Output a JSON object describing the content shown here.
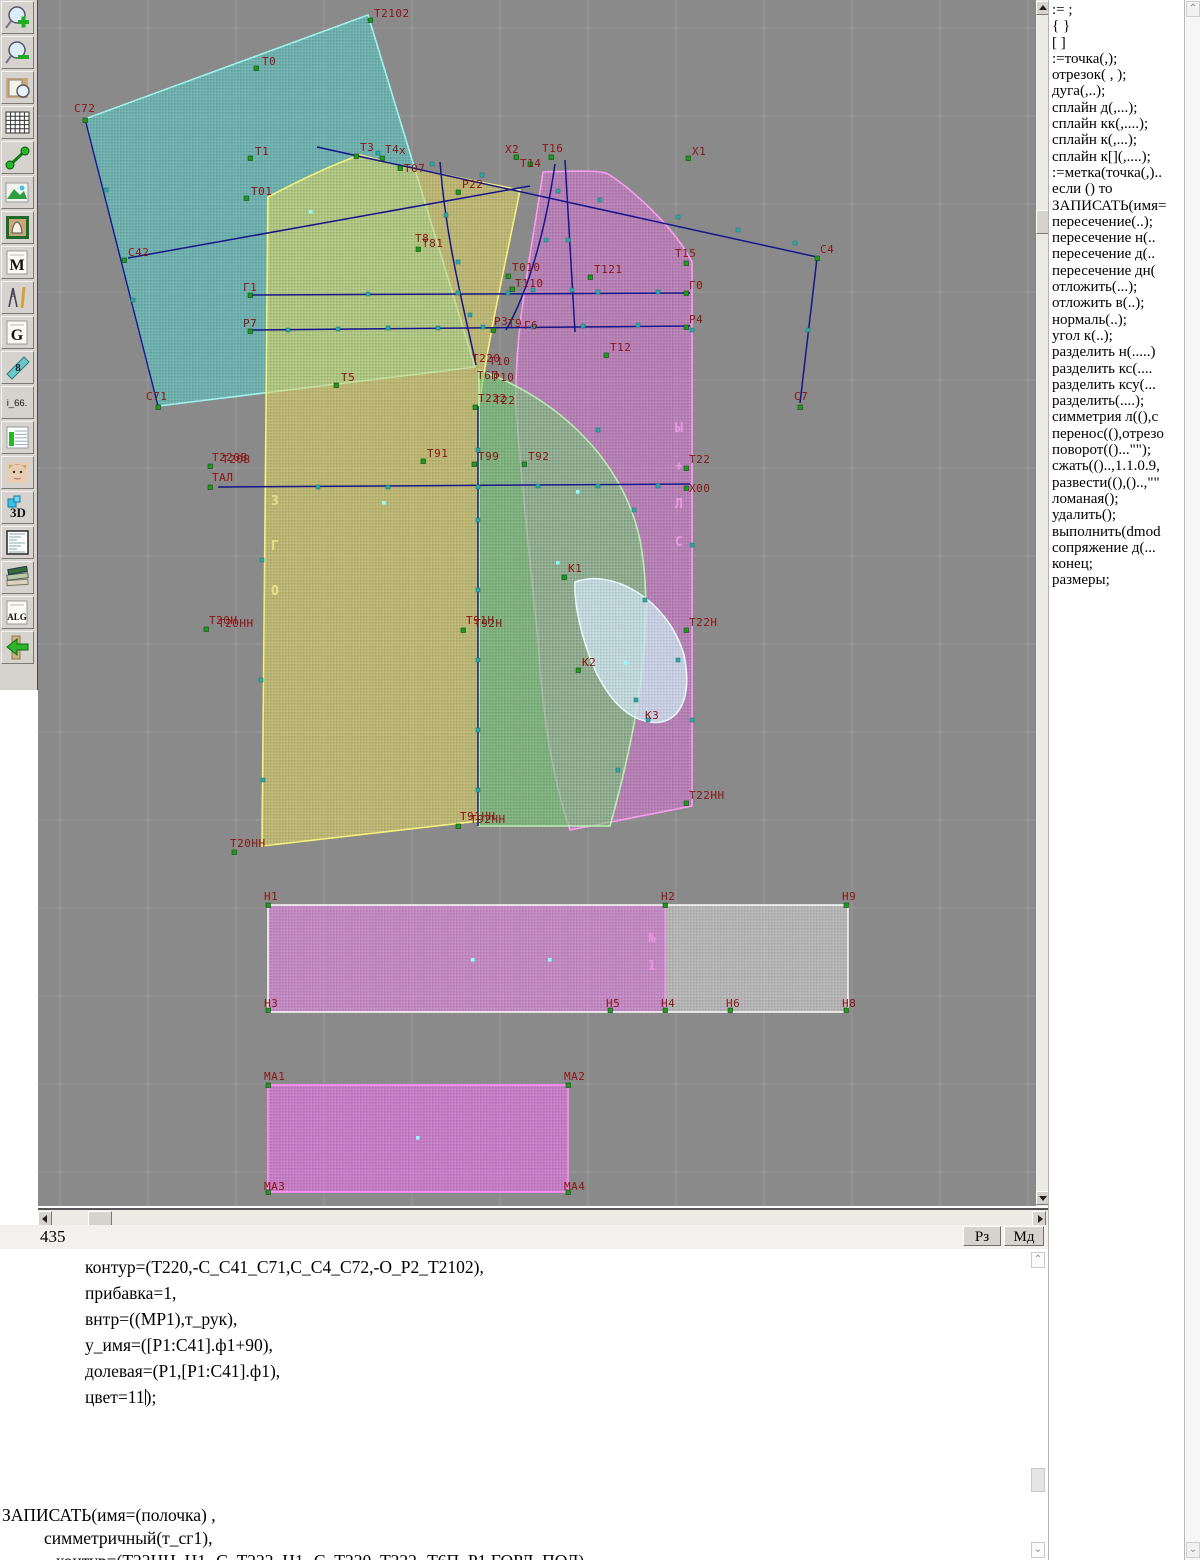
{
  "app": {
    "status_left": "435",
    "mode_buttons": [
      {
        "label": "Рз"
      },
      {
        "label": "Мд"
      }
    ]
  },
  "toolbar": {
    "items": [
      {
        "name": "zoom-in-icon",
        "type": "lensplus",
        "label": ""
      },
      {
        "name": "zoom-out-icon",
        "type": "lensminus",
        "label": ""
      },
      {
        "name": "preview-icon",
        "type": "doclens",
        "label": ""
      },
      {
        "name": "grid-icon",
        "type": "grid",
        "label": ""
      },
      {
        "name": "segment-icon",
        "type": "dumbbell",
        "label": ""
      },
      {
        "name": "image-icon",
        "type": "photo",
        "label": ""
      },
      {
        "name": "pattern-frame-icon",
        "type": "frame",
        "label": ""
      },
      {
        "name": "m-doc-icon",
        "type": "letterdoc",
        "label": "M"
      },
      {
        "name": "drafting-icon",
        "type": "compass",
        "label": ""
      },
      {
        "name": "g-doc-icon",
        "type": "letterdoc",
        "label": "G"
      },
      {
        "name": "ruler-icon",
        "type": "ruler",
        "label": "8"
      },
      {
        "name": "i66-icon",
        "type": "textbtn",
        "label": "i_66."
      },
      {
        "name": "table-chart-icon",
        "type": "chart",
        "label": ""
      },
      {
        "name": "model-photo-icon",
        "type": "face",
        "label": ""
      },
      {
        "name": "3d-icon",
        "type": "threed",
        "label": "3D"
      },
      {
        "name": "list-icon",
        "type": "listdoc",
        "label": ""
      },
      {
        "name": "books-icon",
        "type": "books",
        "label": ""
      },
      {
        "name": "alg-icon",
        "type": "letterdoc",
        "label": "ALG"
      },
      {
        "name": "exit-icon",
        "type": "arrow",
        "label": ""
      }
    ]
  },
  "command_list": [
    ":= ;",
    "{  }",
    "[  ]",
    ":=точка(,);",
    "отрезок( , );",
    "дуга(,..);",
    "сплайн  д(,...);",
    "сплайн  кк(,....);",
    "сплайн  к(,...);",
    "сплайн  к[](,....);",
    ":=метка(точка(,)..",
    "если () то",
    "ЗАПИСАТЬ(имя=",
    "пересечение(..);",
    "пересечение  н(..",
    "пересечение  д(..",
    "пересечение  дн(",
    "отложить(...);",
    "отложить  в(..);",
    "нормаль(..);",
    "угол  к(..);",
    "разделить  н(.....)",
    "разделить  кс(....",
    "разделить  ксу(...",
    "разделить(....);",
    "симметрия  л((),c",
    "перенос((),отрезо",
    "поворот(()...\"\");",
    "сжать(()..,1.1.0.9,",
    "развести((),()..,\"\"",
    "ломаная();",
    "удалить();",
    "выполнить(dmod",
    "сопряжение  д(...",
    "конец;",
    "размеры;"
  ],
  "editor": {
    "block1": [
      "контур=(Т220,-С_С41_С71,С_С4_С72,-О_Р2_Т2102),",
      "прибавка=1,",
      "внтр=((МР1),т_рук),",
      "у_имя=([Р1:С41].ф1+90),",
      "долевая=(Р1,[Р1:С41].ф1),"
    ],
    "cursor_line": {
      "pre": "цвет=11",
      "post": ");"
    },
    "block2": [
      "ЗАПИСАТЬ(имя=(полочка) ,",
      "симметричный(т_сг1),",
      "контур=(Т22НН_Н1,-С_Т222_Н1,-С_Т220_Т222,-Т6П_Р1,ГОРЛ_ПОЛ),"
    ],
    "block2_indents": [
      0,
      42,
      54
    ]
  },
  "canvas": {
    "label_color": "#8b1414",
    "marker_color": "#1f9a1f",
    "teal_color": "#2fa8a8",
    "dot_color": "#8ffcff",
    "line_color": "#16168c",
    "points": [
      [
        "Т2102",
        332,
        20,
        336,
        17
      ],
      [
        "Т0",
        218,
        68,
        224,
        65
      ],
      [
        "С72",
        47,
        120,
        36,
        112
      ],
      [
        "Т1",
        212,
        158,
        217,
        155
      ],
      [
        "Т01",
        208,
        198,
        213,
        195
      ],
      [
        "Т3",
        318,
        156,
        322,
        151
      ],
      [
        "Т4",
        344,
        158,
        347,
        153
      ],
      [
        "х",
        365,
        152,
        361,
        154,
        1
      ],
      [
        "Т07",
        362,
        168,
        366,
        172
      ],
      [
        "Р22",
        420,
        192,
        424,
        188
      ],
      [
        "Х2",
        478,
        157,
        467,
        153
      ],
      [
        "Т14",
        492,
        164,
        482,
        167
      ],
      [
        "Т16",
        513,
        157,
        504,
        152
      ],
      [
        "Х1",
        650,
        158,
        654,
        155
      ],
      [
        "С42",
        86,
        260,
        90,
        256
      ],
      [
        "Т5",
        298,
        385,
        303,
        381
      ],
      [
        "Т8",
        374,
        246,
        377,
        242,
        1
      ],
      [
        "Т81",
        380,
        249,
        384,
        247
      ],
      [
        "Г1",
        212,
        295,
        205,
        291
      ],
      [
        "Г0",
        648,
        293,
        651,
        289
      ],
      [
        "Р7",
        212,
        331,
        205,
        327
      ],
      [
        "Р4",
        648,
        327,
        651,
        323
      ],
      [
        "Т121",
        552,
        277,
        556,
        273
      ],
      [
        "Т15",
        648,
        263,
        637,
        257
      ],
      [
        "Т010",
        470,
        276,
        474,
        271
      ],
      [
        "Т110",
        474,
        289,
        477,
        287
      ],
      [
        "Р3",
        455,
        330,
        456,
        325
      ],
      [
        "Т9",
        468,
        331,
        470,
        327,
        1
      ],
      [
        "Г6",
        482,
        332,
        486,
        329,
        1
      ],
      [
        "Т12",
        568,
        355,
        572,
        351
      ],
      [
        "С4",
        779,
        258,
        782,
        253
      ],
      [
        "С71",
        120,
        407,
        108,
        400
      ],
      [
        "С7",
        762,
        407,
        756,
        400
      ],
      [
        "Т220",
        432,
        367,
        434,
        362,
        1
      ],
      [
        "Т10",
        447,
        369,
        451,
        365,
        1
      ],
      [
        "Т6П",
        437,
        377,
        439,
        379,
        1
      ],
      [
        "Р10",
        452,
        379,
        455,
        381,
        1
      ],
      [
        "Т222",
        437,
        407,
        440,
        402
      ],
      [
        "Т22",
        452,
        408,
        456,
        404,
        1
      ],
      [
        "Т91",
        385,
        461,
        389,
        457
      ],
      [
        "Т99",
        436,
        464,
        440,
        460
      ],
      [
        "Т92",
        486,
        464,
        490,
        460
      ],
      [
        "Т220В",
        172,
        466,
        174,
        461
      ],
      [
        "Т20В",
        180,
        467,
        184,
        463,
        1
      ],
      [
        "ТАЛ",
        172,
        487,
        174,
        481
      ],
      [
        "Т22",
        648,
        468,
        651,
        463
      ],
      [
        "Х00",
        648,
        488,
        651,
        492
      ],
      [
        "К1",
        526,
        577,
        530,
        572
      ],
      [
        "К2",
        540,
        670,
        544,
        666
      ],
      [
        "К3",
        603,
        723,
        607,
        719,
        1
      ],
      [
        "Т20Н",
        168,
        629,
        171,
        624
      ],
      [
        "Т20НН",
        176,
        631,
        180,
        627,
        1
      ],
      [
        "Т91Н",
        425,
        630,
        428,
        624
      ],
      [
        "Т92Н",
        432,
        631,
        436,
        627,
        1
      ],
      [
        "Т22Н",
        648,
        630,
        651,
        626
      ],
      [
        "Т22НН",
        648,
        803,
        651,
        799
      ],
      [
        "Т91НН",
        420,
        826,
        422,
        820
      ],
      [
        "Т92НН",
        428,
        827,
        432,
        823,
        1
      ],
      [
        "Т20НН",
        196,
        852,
        192,
        847
      ],
      [
        "Н1",
        230,
        905,
        226,
        900
      ],
      [
        "Н2",
        627,
        905,
        623,
        900
      ],
      [
        "Н9",
        808,
        905,
        804,
        900
      ],
      [
        "Н3",
        230,
        1010,
        226,
        1007
      ],
      [
        "Н5",
        572,
        1010,
        568,
        1007
      ],
      [
        "Н4",
        627,
        1010,
        623,
        1007
      ],
      [
        "Н6",
        692,
        1010,
        688,
        1007
      ],
      [
        "Н8",
        808,
        1010,
        804,
        1007
      ],
      [
        "МА1",
        230,
        1085,
        226,
        1080
      ],
      [
        "МА2",
        530,
        1085,
        526,
        1080
      ],
      [
        "МА3",
        230,
        1192,
        226,
        1190
      ],
      [
        "МА4",
        530,
        1192,
        526,
        1190
      ]
    ],
    "teal_markers": [
      [
        340,
        153
      ],
      [
        394,
        164
      ],
      [
        444,
        175
      ],
      [
        520,
        191
      ],
      [
        562,
        200
      ],
      [
        640,
        217
      ],
      [
        700,
        230
      ],
      [
        757,
        243
      ],
      [
        770,
        330
      ],
      [
        330,
        294
      ],
      [
        420,
        293
      ],
      [
        470,
        293
      ],
      [
        560,
        292
      ],
      [
        620,
        292
      ],
      [
        250,
        330
      ],
      [
        300,
        329
      ],
      [
        350,
        328
      ],
      [
        400,
        328
      ],
      [
        445,
        327
      ],
      [
        495,
        327
      ],
      [
        545,
        326
      ],
      [
        600,
        325
      ],
      [
        280,
        487
      ],
      [
        350,
        487
      ],
      [
        440,
        487
      ],
      [
        500,
        486
      ],
      [
        560,
        486
      ],
      [
        620,
        486
      ],
      [
        408,
        215
      ],
      [
        420,
        262
      ],
      [
        432,
        315
      ],
      [
        508,
        240
      ],
      [
        495,
        290
      ],
      [
        530,
        240
      ],
      [
        534,
        290
      ],
      [
        440,
        450
      ],
      [
        440,
        520
      ],
      [
        440,
        590
      ],
      [
        440,
        660
      ],
      [
        440,
        730
      ],
      [
        440,
        790
      ],
      [
        68,
        190
      ],
      [
        95,
        300
      ],
      [
        560,
        430
      ],
      [
        596,
        510
      ],
      [
        607,
        600
      ],
      [
        598,
        700
      ],
      [
        580,
        770
      ],
      [
        640,
        660
      ],
      [
        610,
        720
      ],
      [
        654,
        330
      ],
      [
        654,
        545
      ],
      [
        654,
        720
      ],
      [
        224,
        560
      ],
      [
        223,
        680
      ],
      [
        225,
        780
      ]
    ],
    "dots": [
      [
        346,
        503
      ],
      [
        435,
        960
      ],
      [
        512,
        960
      ],
      [
        380,
        1138
      ],
      [
        588,
        663
      ],
      [
        520,
        563
      ],
      [
        540,
        492
      ],
      [
        273,
        212
      ]
    ],
    "vertical_labels": [
      {
        "letters": [
          "Ы",
          "+",
          "Л",
          "С"
        ],
        "x": 637,
        "y0": 432,
        "dy": 38,
        "color": "rgba(255,160,245,0.75)"
      },
      {
        "letters": [
          "З",
          "Г",
          "О"
        ],
        "x": 233,
        "y0": 505,
        "dy": 45,
        "color": "rgba(242,236,140,0.8)"
      },
      {
        "letters": [
          "№",
          "1"
        ],
        "x": 610,
        "y0": 942,
        "dy": 28,
        "color": "rgba(255,150,235,0.7)"
      }
    ]
  }
}
